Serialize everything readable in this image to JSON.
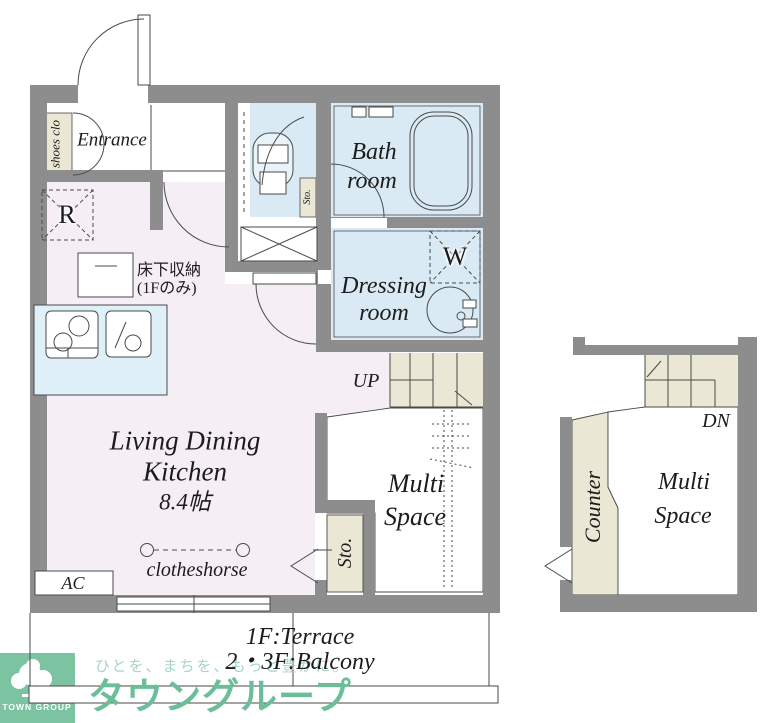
{
  "plan": {
    "entrance": {
      "label": "Entrance"
    },
    "shoes_closet": {
      "label": "shoes clo"
    },
    "refrigerator": {
      "label": "R"
    },
    "underfloor_storage": {
      "line1": "床下収納",
      "line2": "(1Fのみ)"
    },
    "toilet_storage": {
      "label": "Sto."
    },
    "bathroom": {
      "line1": "Bath",
      "line2": "room"
    },
    "dressing_room": {
      "line1": "Dressing",
      "line2": "room"
    },
    "washer": {
      "label": "W"
    },
    "ldk": {
      "line1": "Living Dining",
      "line2": "Kitchen",
      "size": "8.4帖"
    },
    "clotheshorse": {
      "label": "clotheshorse"
    },
    "ac": {
      "label": "AC"
    },
    "stairs_up": {
      "label": "UP"
    },
    "stairs_down": {
      "label": "DN"
    },
    "storage_1f": {
      "label": "Sto."
    },
    "multi_space_1f": {
      "line1": "Multi",
      "line2": "Space"
    },
    "counter": {
      "label": "Counter"
    },
    "multi_space_upper": {
      "line1": "Multi",
      "line2": "Space"
    }
  },
  "annotations": {
    "terrace": "1F:Terrace",
    "balcony": "2・3F:Balcony"
  },
  "branding": {
    "logo_text": "TOWN GROUP",
    "tagline": "ひとを、まちを、もっと豊かに。",
    "company": "タウングループ"
  },
  "colors": {
    "wall_gray": "#8d8d8d",
    "room_pink": "#f5eef5",
    "wet_blue": "#d9eaf4",
    "kitchen_blue": "#dff0f8",
    "tatami_beige": "#eae7d4",
    "logo_green": "#7cc3a1",
    "company_green": "#6cbe99",
    "tagline_green": "#a5d6c2",
    "line_dark": "#4a4a4a"
  }
}
